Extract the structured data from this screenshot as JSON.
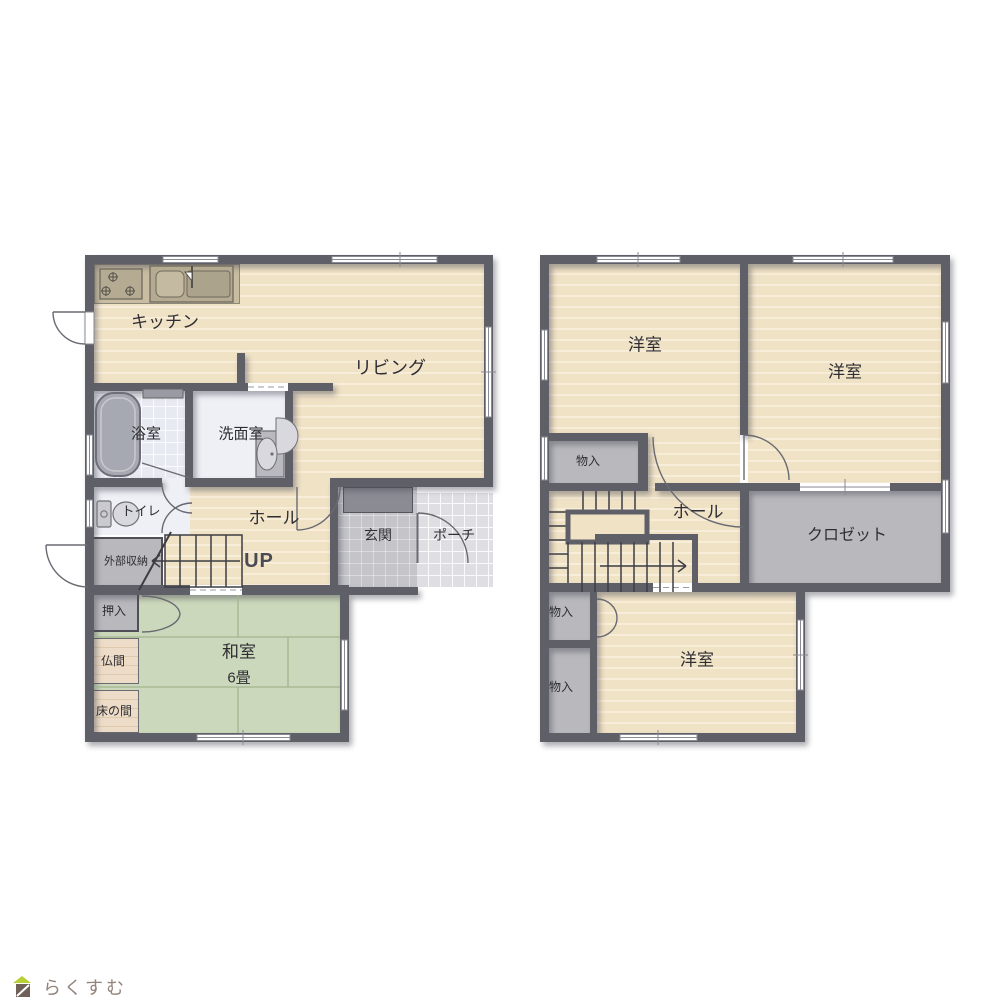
{
  "palette": {
    "wall": "#5f5f68",
    "floor": "#f0e2c5",
    "floorStripe": "#f8edd8",
    "tatami": "#ccd8bb",
    "tatamiLine": "#a3b48e",
    "gray": "#b9b9bd",
    "tileDark": "#c4c4c9",
    "tileLight": "#dfdfe3",
    "bath": "#e7eaf0",
    "whitefloor": "#eef0f5",
    "wood": "#eddcc7",
    "woodStripe": "#dfc9ae",
    "counter": "#c8bca1",
    "line": "#6a6a72",
    "stairLine": "#3d3d44",
    "text": "#2e2e33",
    "upText": "#4b4b54",
    "logoGreen": "#b9cf33",
    "logoBrown": "#6f6058",
    "logoText": "#93837a"
  },
  "floor1": {
    "rooms": [
      {
        "id": "kitchen",
        "label": "キッチン"
      },
      {
        "id": "living",
        "label": "リビング"
      },
      {
        "id": "bath",
        "label": "浴室"
      },
      {
        "id": "washroom",
        "label": "洗面室"
      },
      {
        "id": "toilet",
        "label": "トイレ"
      },
      {
        "id": "hall",
        "label": "ホール"
      },
      {
        "id": "stairs-up",
        "label": "UP"
      },
      {
        "id": "external-storage",
        "label": "外部収納"
      },
      {
        "id": "entrance",
        "label": "玄関"
      },
      {
        "id": "porch",
        "label": "ポーチ"
      },
      {
        "id": "oshiire",
        "label": "押入"
      },
      {
        "id": "butsuma",
        "label": "仏間"
      },
      {
        "id": "tokonoma",
        "label": "床の間"
      },
      {
        "id": "washitsu",
        "label": "和室"
      },
      {
        "id": "washitsu-size",
        "label": "6畳"
      }
    ]
  },
  "floor2": {
    "rooms": [
      {
        "id": "bedroom-nw",
        "label": "洋室"
      },
      {
        "id": "bedroom-ne",
        "label": "洋室"
      },
      {
        "id": "storage-upper",
        "label": "物入"
      },
      {
        "id": "hall",
        "label": "ホール"
      },
      {
        "id": "closet",
        "label": "クロゼット"
      },
      {
        "id": "storage-mid",
        "label": "物入"
      },
      {
        "id": "storage-lower",
        "label": "物入"
      },
      {
        "id": "bedroom-s",
        "label": "洋室"
      }
    ]
  },
  "icons": {
    "stove": "stove-icon",
    "kitchen_sink": "kitchen-sink-icon",
    "bathtub": "bathtub-icon",
    "washbasin": "washbasin-icon",
    "toilet": "toilet-icon",
    "shoe_cabinet": "shoe-cabinet-icon",
    "stairs_first_floor": "staircase-icon",
    "stairs_second_floor": "staircase-icon",
    "logo_house": "house-icon"
  },
  "logo": {
    "text": "らくすむ"
  }
}
